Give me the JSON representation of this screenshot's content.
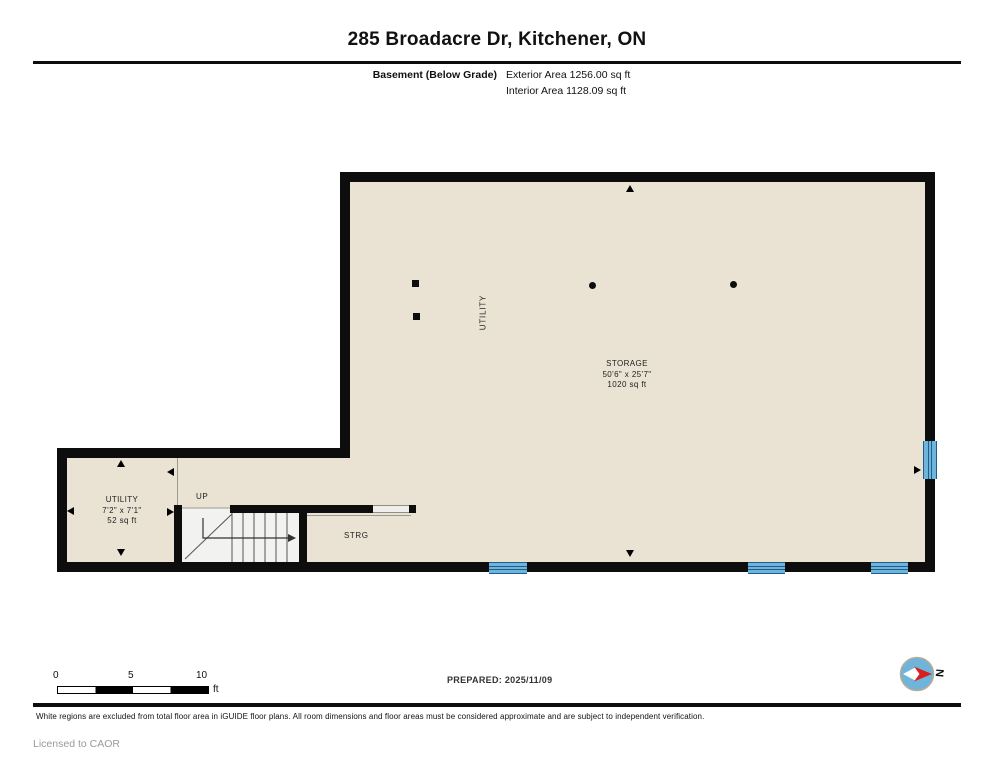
{
  "header": {
    "title": "285 Broadacre Dr, Kitchener, ON",
    "floor_label": "Basement (Below Grade)",
    "exterior_area": "Exterior Area 1256.00 sq ft",
    "interior_area": "Interior Area 1128.09 sq ft"
  },
  "plan": {
    "rooms": {
      "storage": {
        "name": "STORAGE",
        "dims": "50'6\" x 25'7\"",
        "area": "1020 sq ft"
      },
      "utility": {
        "name": "UTILITY",
        "dims": "7'2\" x 7'1\"",
        "area": "52 sq ft"
      },
      "utility_zone": "UTILITY",
      "storage_closet": "STRG",
      "stairs_up": "UP"
    }
  },
  "scale_bar": {
    "tick_0": "0",
    "tick_5": "5",
    "tick_10": "10",
    "unit": "ft"
  },
  "prepared_label": "PREPARED: 2025/11/09",
  "compass_label": "N",
  "footer": {
    "disclaimer": "White regions are excluded from total floor area in iGUIDE floor plans. All room dimensions and floor areas must be considered approximate and are subject to independent verification.",
    "license": "Licensed to CAOR"
  },
  "colors": {
    "floor_fill": "#EAE2D2",
    "wall": "#0D0D0D",
    "window_blue": "#6FB4DB",
    "window_frame": "#1D5E8C",
    "stair_fill": "#F2F2F0",
    "compass_red": "#D91E1E"
  }
}
